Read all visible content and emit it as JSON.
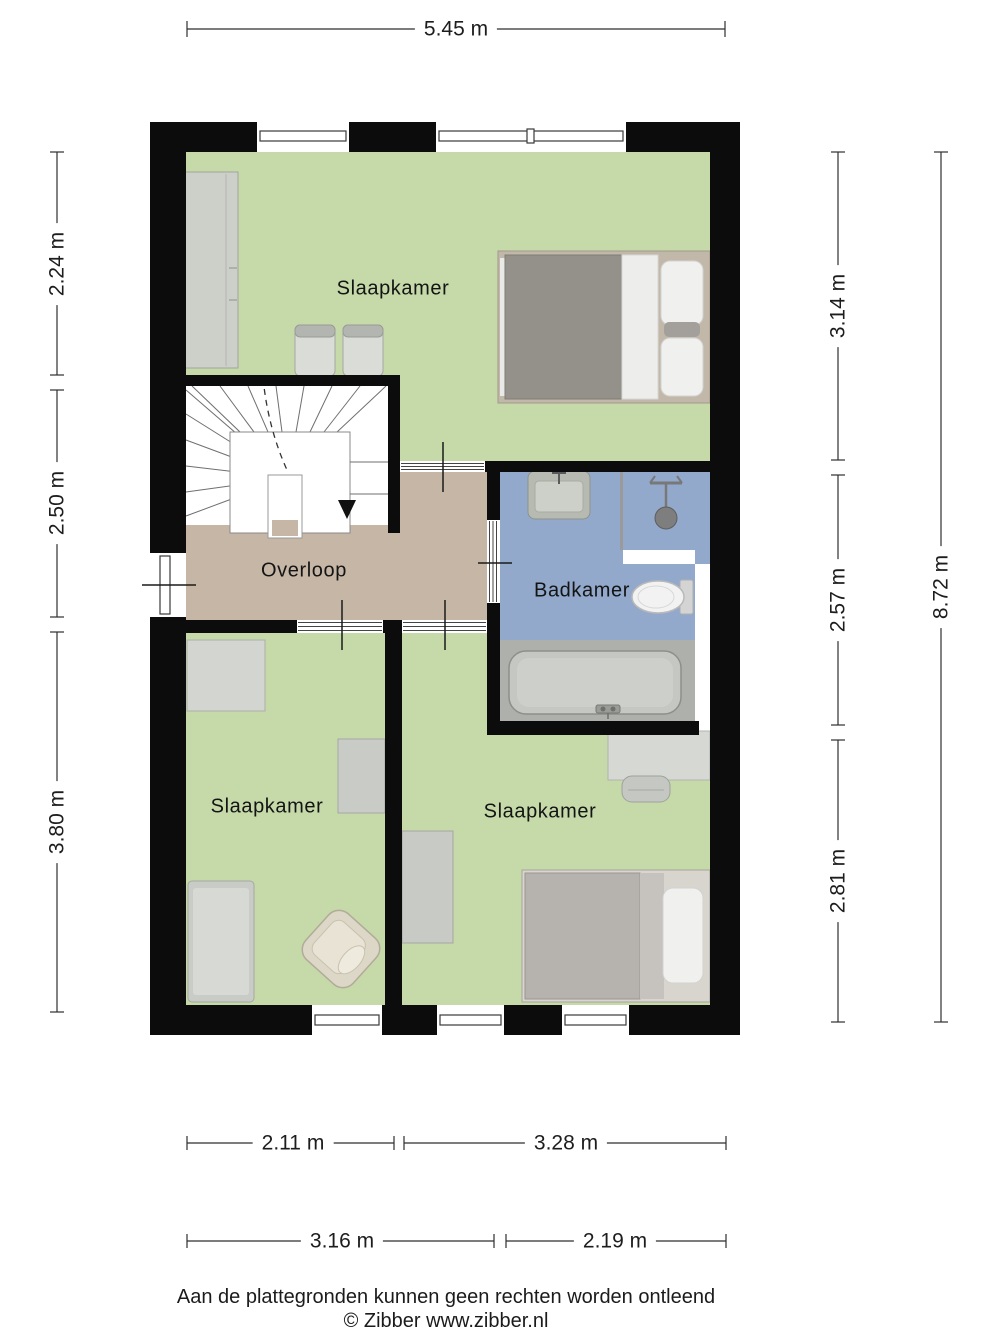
{
  "plan": {
    "rooms": [
      {
        "id": "bedroom-top",
        "label": "Slaapkamer",
        "floor_color": "#c5d9a9"
      },
      {
        "id": "landing",
        "label": "Overloop",
        "floor_color": "#c6b6a6"
      },
      {
        "id": "bathroom",
        "label": "Badkamer",
        "floor_color": "#92a9cc"
      },
      {
        "id": "bedroom-left",
        "label": "Slaapkamer",
        "floor_color": "#c5d9a9"
      },
      {
        "id": "bedroom-right",
        "label": "Slaapkamer",
        "floor_color": "#c5d9a9"
      }
    ],
    "wall_color": "#0c0c0c",
    "fixtures": [
      "double-bed",
      "wardrobe",
      "chairs",
      "stairs",
      "sink",
      "shower",
      "toilet",
      "bathtub",
      "desk",
      "desk-chair",
      "single-bed",
      "bed",
      "armchair",
      "closet"
    ]
  },
  "dimensions": {
    "top": {
      "label": "5.45 m"
    },
    "left": [
      {
        "label": "2.24 m"
      },
      {
        "label": "2.50 m"
      },
      {
        "label": "3.80 m"
      }
    ],
    "right": [
      {
        "label": "3.14 m"
      },
      {
        "label": "2.57 m"
      },
      {
        "label": "2.81 m"
      }
    ],
    "right_total": {
      "label": "8.72 m"
    },
    "bottom_upper": [
      {
        "label": "2.11 m"
      },
      {
        "label": "3.28 m"
      }
    ],
    "bottom_lower": [
      {
        "label": "3.16 m"
      },
      {
        "label": "2.19 m"
      }
    ]
  },
  "footer": {
    "disclaimer": "Aan de plattegronden kunnen geen rechten worden ontleend",
    "copyright": "© Zibber www.zibber.nl"
  }
}
